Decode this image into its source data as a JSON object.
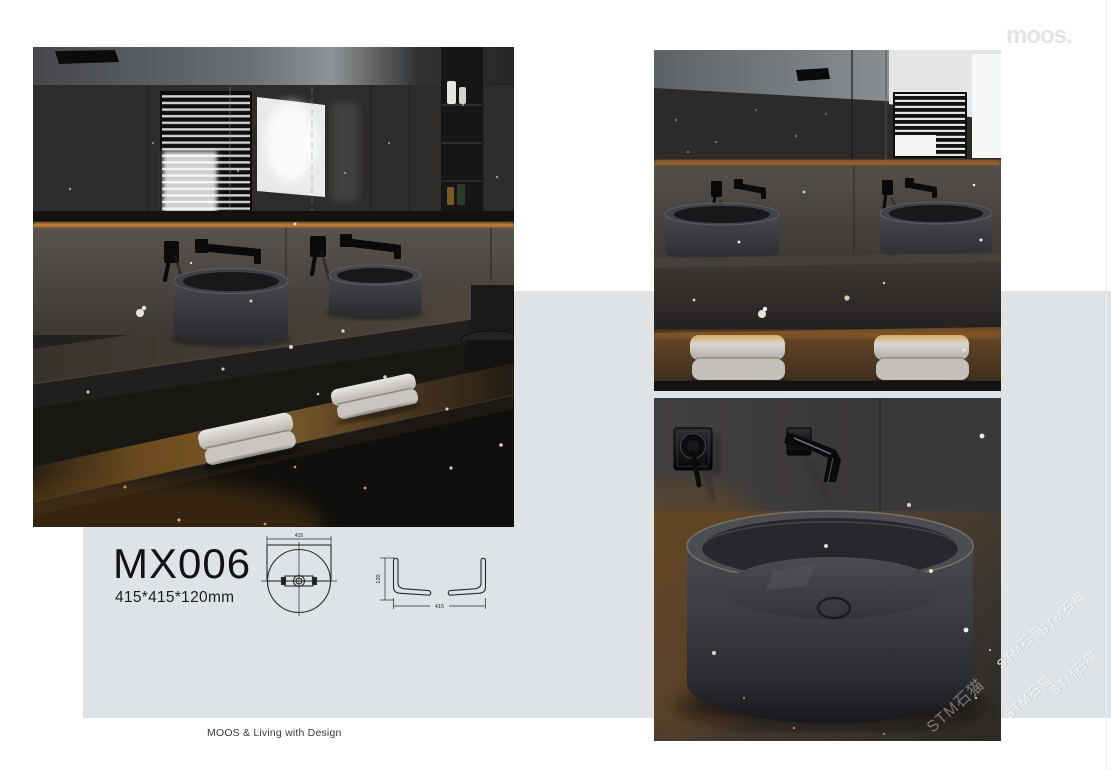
{
  "brand": {
    "logo_text": "moos."
  },
  "product": {
    "code": "MX006",
    "dimensions": "415*415*120mm"
  },
  "technical_drawings": {
    "top_view": {
      "width_label": "415"
    },
    "side_view": {
      "height_label": "120",
      "width_label": "415"
    }
  },
  "footer": {
    "tagline": "MOOS & Living with Design"
  },
  "watermark": {
    "text": "STM石猫"
  },
  "colors": {
    "band": "#e0e3e5",
    "logo": "#e3e4e5",
    "charcoal": "#242322",
    "amber_glow": "#c9813a",
    "text_dark": "#111116"
  },
  "images": {
    "hero": "dark-bathroom-double-vanity",
    "secondary": "double-basin-with-towels",
    "detail": "round-basin-faucet-closeup"
  }
}
